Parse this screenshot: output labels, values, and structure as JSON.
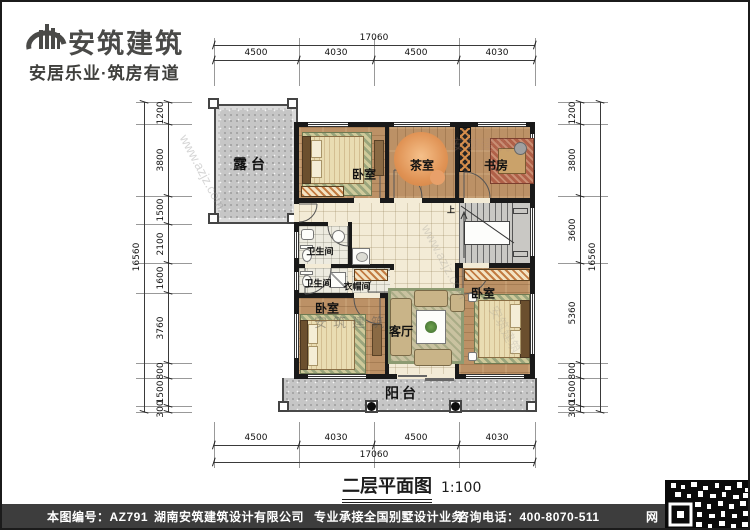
{
  "brand": {
    "name": "安筑建筑",
    "slogan": "安居乐业·筑房有道",
    "logo_icon": "building-swoosh-logo"
  },
  "plan": {
    "rooms": [
      {
        "id": "terrace",
        "label": "露台"
      },
      {
        "id": "bedroom-top",
        "label": "卧室"
      },
      {
        "id": "tea-room",
        "label": "茶室"
      },
      {
        "id": "study",
        "label": "书房"
      },
      {
        "id": "bathroom-upper",
        "label": "卫生间"
      },
      {
        "id": "bathroom-lower",
        "label": "卫生间"
      },
      {
        "id": "cloakroom",
        "label": "衣帽间"
      },
      {
        "id": "bedroom-left",
        "label": "卧室"
      },
      {
        "id": "living-room",
        "label": "客厅"
      },
      {
        "id": "bedroom-right",
        "label": "卧室"
      },
      {
        "id": "balcony",
        "label": "阳台"
      }
    ],
    "stair_up_label": "上"
  },
  "dims": {
    "top": {
      "overall": "17060",
      "segments": [
        "4500",
        "4030",
        "4500",
        "4030"
      ]
    },
    "bottom": {
      "overall": "17060",
      "segments": [
        "4500",
        "4030",
        "4500",
        "4030"
      ]
    },
    "left": {
      "overall": "16560",
      "segments": [
        "1200",
        "3800",
        "1500",
        "2100",
        "1600",
        "3760",
        "800",
        "1500",
        "300"
      ]
    },
    "right": {
      "overall": "16560",
      "segments": [
        "1200",
        "3800",
        "3600",
        "5360",
        "800",
        "1500",
        "300"
      ]
    }
  },
  "title": {
    "text": "二层平面图",
    "scale": "1:100"
  },
  "watermarks": {
    "site": "www.azjz.com",
    "brand": "安筑建筑"
  },
  "footer": {
    "drawing_no": "本图编号：AZ791",
    "company": "湖南安筑建筑设计有限公司",
    "service": "专业承接全国别墅设计业务",
    "phone": "咨询电话：400-8070-511",
    "web": "网"
  },
  "colors": {
    "wall": "#191919",
    "wood_floor": "#bc9166",
    "tile_floor": "#f3ebd6",
    "concrete": "#c6c6c6",
    "footer_bar": "#3d3d3d",
    "brand_text": "#4a4a48"
  }
}
